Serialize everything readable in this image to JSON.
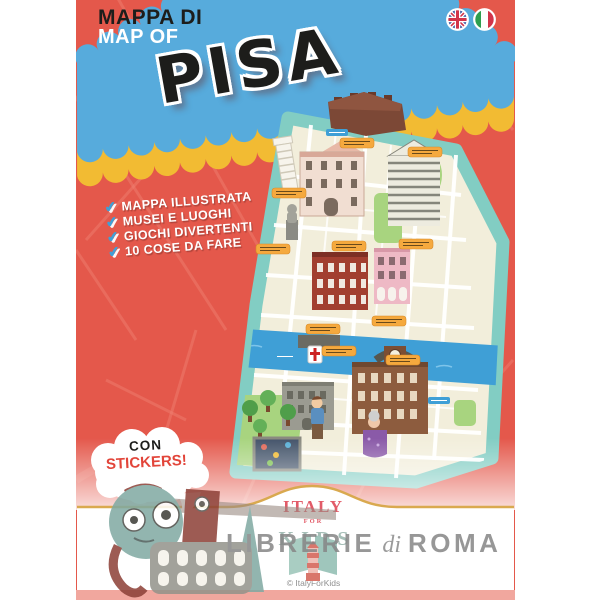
{
  "header": {
    "subtitle_line1": "MAPPA DI",
    "subtitle_line2": "MAP OF",
    "title": "PISA",
    "flag_icons": [
      "uk-flag-icon",
      "italy-flag-icon"
    ]
  },
  "features": {
    "check_icon": "checkmark-icon",
    "check_glyph": "✔",
    "items": [
      "MAPPA ILLUSTRATA",
      "MUSEI E LUOGHI",
      "GIOCHI DIVERTENTI",
      "10 COSE DA FARE"
    ]
  },
  "sticker_bubble": {
    "line1": "CON",
    "line2": "STICKERS!"
  },
  "brand": {
    "line1": "ITALY",
    "line2": "FOR",
    "line3": "KIDS",
    "copyright": "© ItalyForKids"
  },
  "watermark": {
    "part1": "LIBRERIE",
    "part2": "di",
    "part3": "ROMA"
  },
  "colors": {
    "cover_red": "#e4584b",
    "street_line": "#f08273",
    "banner_blue": "#57abdc",
    "banner_yellow": "#f2bb33",
    "title_ink": "#1d1d1b",
    "map_border": "#82cdc3",
    "map_paper": "#f2eedb",
    "river": "#3f9fd6",
    "park": "#a8d47f",
    "label_orange": "#f5a93e",
    "sticker_red": "#e2453a",
    "check_blue": "#3f9fd6",
    "gold_line": "#d9a94f",
    "brand_red": "#e25b68",
    "brand_teal": "#a5beb7",
    "watermark_gray": "#868686",
    "bottom_strip_pink": "#f1a79e"
  }
}
